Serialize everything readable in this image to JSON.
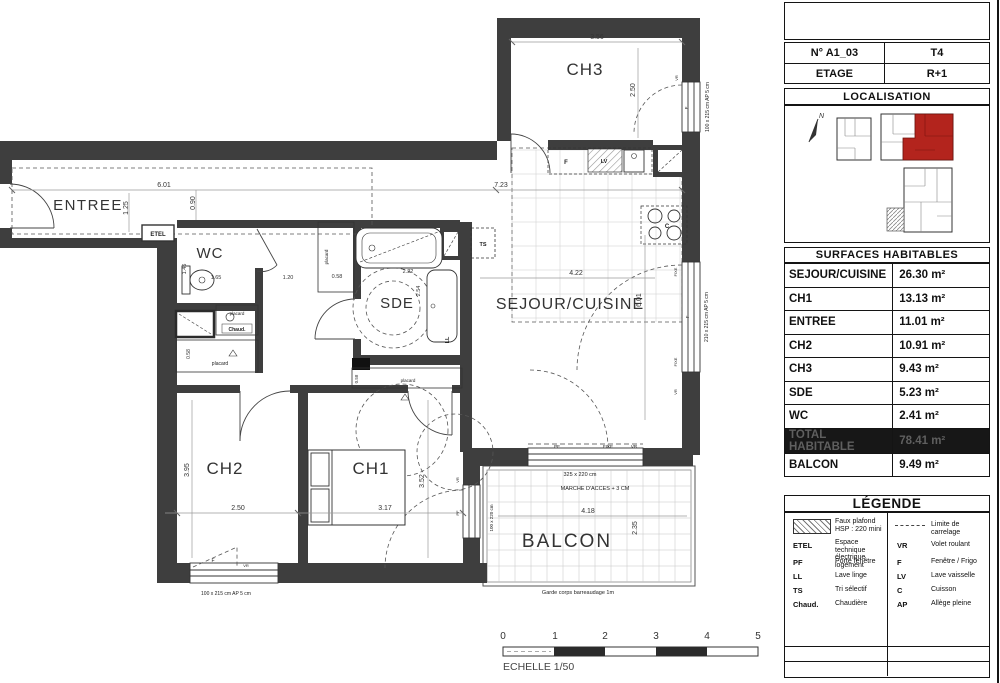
{
  "colors": {
    "wall": "#3e3e3e",
    "highlight_red": "#b3241d"
  },
  "panel": {
    "unit": {
      "number": "N° A1_03",
      "type": "T4",
      "floor_label": "ETAGE",
      "floor_value": "R+1"
    },
    "localisation": {
      "title": "LOCALISATION",
      "north": "N"
    },
    "surfaces": {
      "title": "SURFACES HABITABLES",
      "rows": [
        {
          "label": "SEJOUR/CUISINE",
          "value": "26.30 m²"
        },
        {
          "label": "CH1",
          "value": "13.13 m²"
        },
        {
          "label": "ENTREE",
          "value": "11.01 m²"
        },
        {
          "label": "CH2",
          "value": "10.91 m²"
        },
        {
          "label": "CH3",
          "value": "9.43 m²"
        },
        {
          "label": "SDE",
          "value": "5.23 m²"
        },
        {
          "label": "WC",
          "value": "2.41 m²"
        },
        {
          "label": "TOTAL HABITABLE",
          "value": "78.41 m²"
        },
        {
          "label": "BALCON",
          "value": "9.49 m²"
        }
      ]
    },
    "legend": {
      "title": "LÉGENDE",
      "left": [
        {
          "key": "",
          "desc": "Faux plafond",
          "desc2": "HSP : 220 mini"
        },
        {
          "key": "ETEL",
          "desc": "Espace technique électrique logement"
        },
        {
          "key": "PF",
          "desc": "Porte fenêtre"
        },
        {
          "key": "LL",
          "desc": "Lave linge"
        },
        {
          "key": "TS",
          "desc": "Tri sélectif"
        },
        {
          "key": "Chaud.",
          "desc": "Chaudière"
        }
      ],
      "right": [
        {
          "key": "",
          "desc": "Limite de carrelage"
        },
        {
          "key": "VR",
          "desc": "Volet roulant"
        },
        {
          "key": "F",
          "desc": "Fenêtre / Frigo"
        },
        {
          "key": "LV",
          "desc": "Lave vaisselle"
        },
        {
          "key": "C",
          "desc": "Cuisson"
        },
        {
          "key": "AP",
          "desc": "Allège pleine"
        }
      ]
    }
  },
  "plan": {
    "rooms": {
      "entree": "ENTREE",
      "wc": "WC",
      "sde": "SDE",
      "ch3": "CH3",
      "sejour": "SEJOUR/CUISINE",
      "ch2": "CH2",
      "ch1": "CH1",
      "balcon": "BALCON"
    },
    "dims": {
      "entree_w": "6.01",
      "entree_h": "1.25",
      "d090": "0.90",
      "top_w": "7.23",
      "ch3_w": "3.56",
      "ch3_h": "2.50",
      "wc_h": "1.46",
      "wc_w": "1.65",
      "hall_w": "1.20",
      "plac1": "0.58",
      "plac2": "0.58",
      "plac3": "0.58",
      "sde_w": "2.22",
      "sde_h": "2.54",
      "sej_w": "4.22",
      "sej_h": "6.01",
      "ch2_h": "3.95",
      "ch2_w": "2.50",
      "ch1_w": "3.17",
      "ch1_h": "3.52",
      "balc_w": "4.18",
      "balc_h": "2.35"
    },
    "windows": {
      "ch3": "100 x 215 cm  AP 5 cm",
      "sejour": "210 x 215 cm  AP 5 cm",
      "ch2": "100 x 215 cm  AP 5 cm",
      "balcon_left": "100 x 220 cm",
      "balcon_size": "325 x 220 cm"
    },
    "ann": {
      "marche": "MARCHE D'ACCES + 3 CM",
      "garde": "Garde corps barreaudage 1m",
      "etel": "ETEL",
      "ts": "TS",
      "ll": "LL",
      "lv": "LV",
      "f": "F",
      "c": "C",
      "chaud": "Chaud.",
      "placard": "placard",
      "pf": "PF",
      "fixe": "FIXE",
      "vr": "VR"
    },
    "scalebar": {
      "ticks": [
        "0",
        "1",
        "2",
        "3",
        "4",
        "5"
      ],
      "label": "ECHELLE 1/50"
    }
  }
}
